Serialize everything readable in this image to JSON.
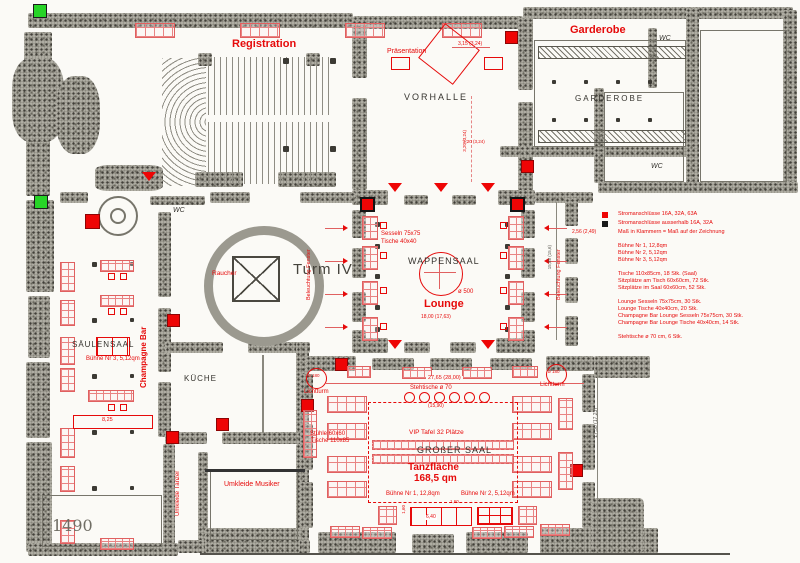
{
  "plan": {
    "rooms": {
      "registration": "Registration",
      "praesentation": "Präsentation",
      "garderobe_label": "Garderobe",
      "garderobe_room": "GARDEROBE",
      "vorhalle": "VORHALLE",
      "wappensaal": "WAPPENSAAL",
      "lounge": "Lounge",
      "turm": "Turm IV",
      "raucher": "Raucher",
      "saeulensaal": "SÄULENSAAL",
      "champagne_bar": "Champagne Bar",
      "kueche": "KÜCHE",
      "umkleide_taenzer": "Umkleide Tänzer",
      "umkleide_musiker": "Umkleide Musiker",
      "grosser_saal": "GROßER SAAL",
      "wc": "WC",
      "handwriting": "1490"
    },
    "features": {
      "tanzflaeche": "Tanzfläche",
      "tanzflaeche_qm": "168,5 qm",
      "vip": "VIP Tafel 32 Plätze",
      "stehtische": "Stehtische ø 70",
      "lichtturm": "Lichtturm",
      "d180": "ø 180",
      "d500": "ø 500",
      "buehne1": "Bühne Nr 1, 12,8qm",
      "buehne2": "Bühne Nr 2, 5,12qm",
      "buehne3": "Bühne Nr 3, 5,12qm",
      "sesseln": "Sesseln 75x75",
      "tische40": "Tische 40x40",
      "stuehle": "Stühle 60x60",
      "tische110": "Tische 110x85",
      "beleuchtung": "Beleuchtung Fenster"
    },
    "dims": {
      "d315": "3,15 (3,24)",
      "d320": "3,20 (3,24)",
      "d1800": "18,00 (17,63)",
      "d1588": "15,88 (15,6)",
      "d2765": "27,65 (28,00)",
      "d1590": "(15,90)",
      "d825": "8,25",
      "d640": "6,40",
      "d160": "1,60",
      "d1738": "17,38 (17,23)",
      "d256": "2,56 (2,49)"
    },
    "legend": {
      "power_red": "Stromanschlüsse 16A, 32A, 63A",
      "power_black": "Stromanschlüsse ausserhalb 16A, 32A",
      "dim_note": "Maß in Klammern = Maß auf der Zeichnung",
      "stage1": "Bühne Nr 1, 12,8qm",
      "stage2": "Bühne Nr 2, 5,12qm",
      "stage3": "Bühne Nr 3, 5,12qm",
      "tables_saal": "Tische 110x85cm, 18 Stk. (Saal)",
      "seats_table": "Sitzplätze am Tisch 60x60cm, 72 Stk.",
      "seats_saal": "Sitzplätze im Saal 60x60cm, 52 Stk.",
      "lounge_chairs": "Lounge Sesseln 75x75cm, 30 Stk.",
      "lounge_tables": "Lounge Tische 40x40cm, 20 Stk.",
      "cb_chairs": "Champagne Bar Lounge Sesseln 75x75cm, 30 Stk.",
      "cb_tables": "Champagne Bar Lounge Tische 40x40cm, 14 Stk.",
      "standing": "Stehtische ø 70 cm, 6 Stk."
    },
    "colors": {
      "annotation": "#e60a0a",
      "power": "#ee0505",
      "power_outside": "#1a1a1a",
      "marker_green": "#27d427"
    }
  }
}
